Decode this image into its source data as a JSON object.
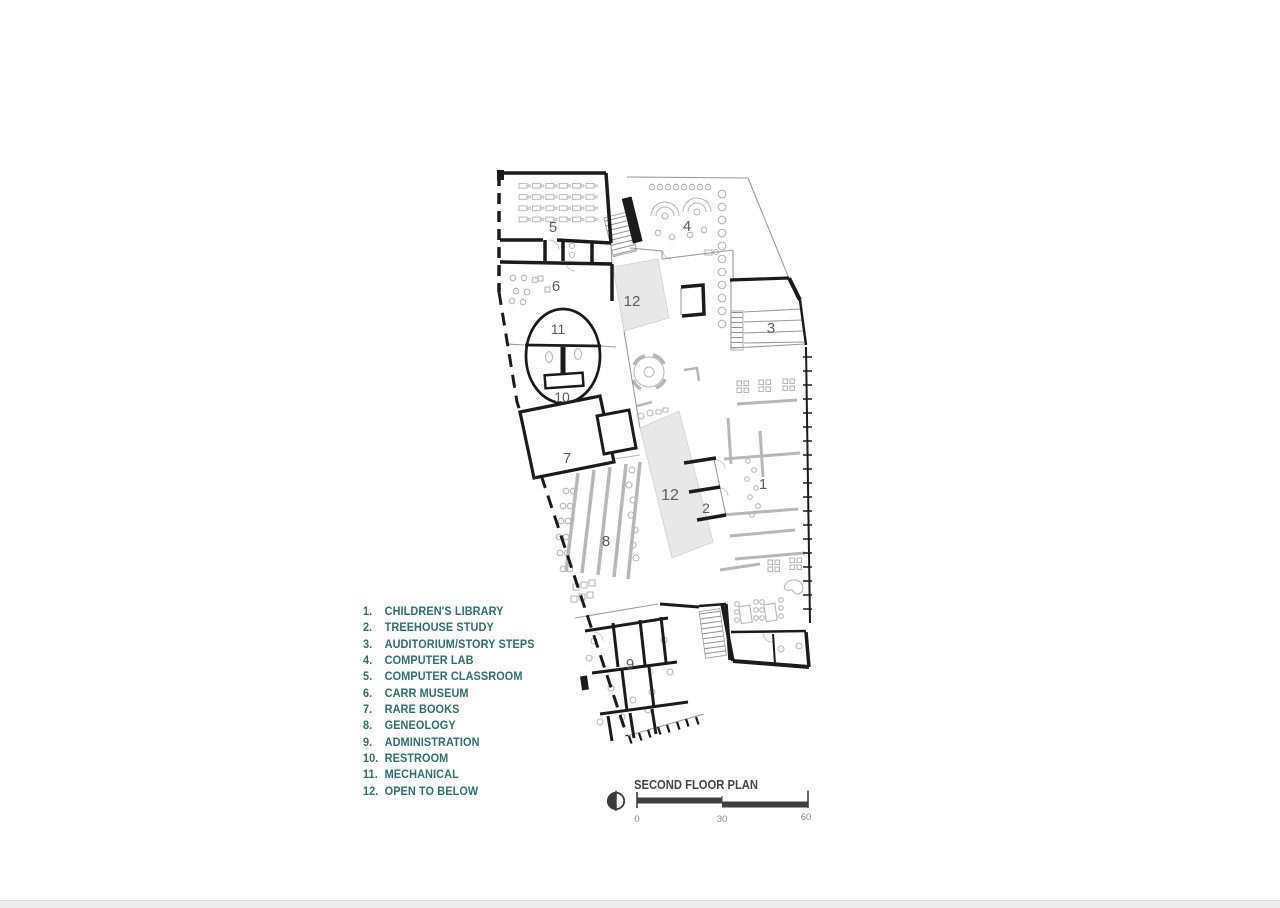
{
  "page": {
    "background": "#ffffff",
    "type_note": "architectural drawing sheet"
  },
  "legend": {
    "items": [
      {
        "n": "1.",
        "label": "CHILDREN'S LIBRARY"
      },
      {
        "n": "2.",
        "label": "TREEHOUSE STUDY"
      },
      {
        "n": "3.",
        "label": "AUDITORIUM/STORY STEPS"
      },
      {
        "n": "4.",
        "label": "COMPUTER LAB"
      },
      {
        "n": "5.",
        "label": "COMPUTER CLASSROOM"
      },
      {
        "n": "6.",
        "label": "CARR MUSEUM"
      },
      {
        "n": "7.",
        "label": "RARE BOOKS"
      },
      {
        "n": "8.",
        "label": "GENEOLOGY"
      },
      {
        "n": "9.",
        "label": "ADMINISTRATION"
      },
      {
        "n": "10.",
        "label": "RESTROOM"
      },
      {
        "n": "11.",
        "label": "MECHANICAL"
      },
      {
        "n": "12.",
        "label": "OPEN TO BELOW"
      }
    ],
    "text_color": "#2e6f6f"
  },
  "plan": {
    "rooms": {
      "r1": "1",
      "r2": "2",
      "r3": "3",
      "r4": "4",
      "r5": "5",
      "r6": "6",
      "r7": "7",
      "r8": "8",
      "r9": "9",
      "r10": "10",
      "r11": "11",
      "r12": "12"
    },
    "wall_color": "#1b1b1b",
    "furniture_color": "#b7b7b7",
    "open_to_below_fill": "#e8e8e8"
  },
  "titleblock": {
    "title": "SECOND FLOOR PLAN",
    "title_color": "#454545",
    "scale_ticks": [
      "0",
      "30",
      "60"
    ],
    "icons": {
      "north": "north-arrow"
    }
  }
}
